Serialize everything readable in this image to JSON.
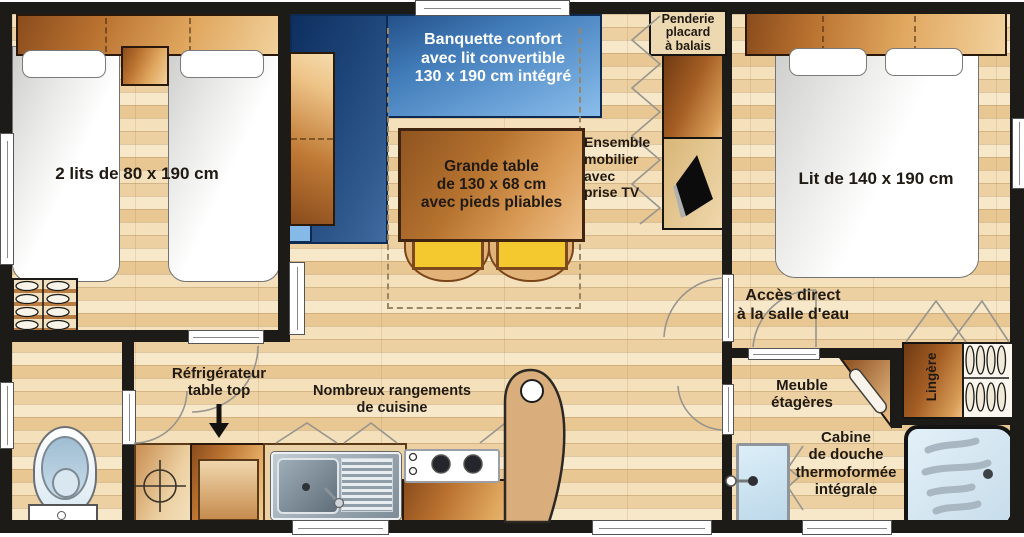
{
  "labels": {
    "beds_left": "2 lits de 80 x 190 cm",
    "banquette": "Banquette confort\navec lit convertible\n130 x 190 cm intégré",
    "table": "Grande table\nde 130 x 68 cm\navec pieds pliables",
    "penderie": "Penderie\nplacard\nà balais",
    "ensemble": "Ensemble\nmobilier\navec\nprise TV",
    "bed_right": "Lit de 140 x 190 cm",
    "acces": "Accès direct\nà la salle d'eau",
    "meuble": "Meuble\nétagères",
    "lingere": "Lingère",
    "cabine": "Cabine\nde douche\nthermoformée\nintégrale",
    "refrigerateur": "Réfrigérateur\ntable top",
    "rangements": "Nombreux rangements\nde cuisine"
  },
  "colors": {
    "wall": "#1d1b18",
    "floor_light": "#f8e8ca",
    "floor_dark": "#e9c793",
    "wood_dark": "#8a4c1d",
    "wood_light": "#f2d29e",
    "banquette_dark": "#10356b",
    "banquette_light": "#8abdea",
    "chair_yellow": "#f4c930",
    "shower_blue": "#d9e9f4",
    "text_dark": "#201a12",
    "text_light": "#ffffff"
  }
}
